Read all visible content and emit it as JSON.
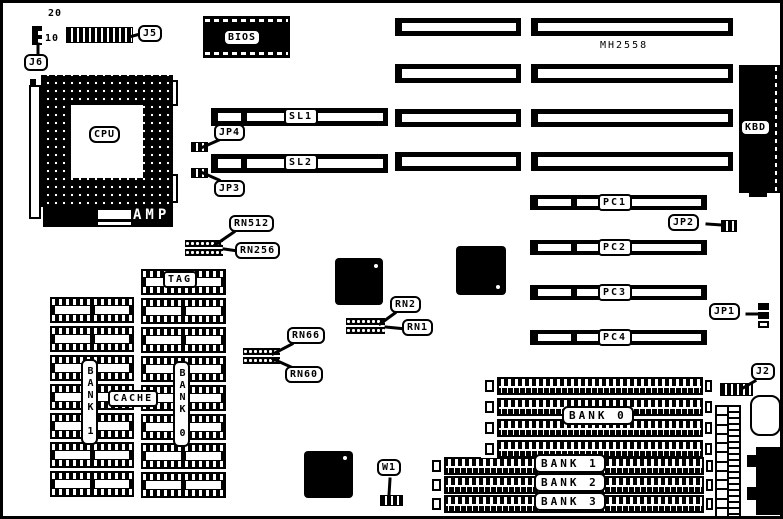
{
  "board": {
    "chip_marking": "MH2558",
    "pin_numbers": {
      "j5_top": "20",
      "j5_bottom": "10"
    },
    "components": {
      "j5": "J5",
      "j6": "J6",
      "bios": "BIOS",
      "cpu": "CPU",
      "amp": "AMP",
      "kbd": "KBD",
      "sl1": "SL1",
      "sl2": "SL2",
      "jp4": "JP4",
      "jp3": "JP3",
      "jp2": "JP2",
      "jp1": "JP1",
      "j2": "J2",
      "w1": "W1",
      "pc1": "PC1",
      "pc2": "PC2",
      "pc3": "PC3",
      "pc4": "PC4",
      "rn512": "RN512",
      "rn256": "RN256",
      "rn66": "RN66",
      "rn60": "RN60",
      "rn2": "RN2",
      "rn1": "RN1",
      "tag": "TAG",
      "cache": "CACHE",
      "cache_bank_left": "BANK 1",
      "cache_bank_right": "BANK 0",
      "simm_bank0": "BANK 0",
      "simm_bank1": "BANK 1",
      "simm_bank2": "BANK 2",
      "simm_bank3": "BANK 3"
    },
    "counts": {
      "cache_rows_left": 7,
      "cache_rows_right": 8,
      "bank0_slots": 4,
      "vconn_pins": 12
    },
    "colors": {
      "ink": "#000000",
      "paper": "#ffffff"
    }
  }
}
